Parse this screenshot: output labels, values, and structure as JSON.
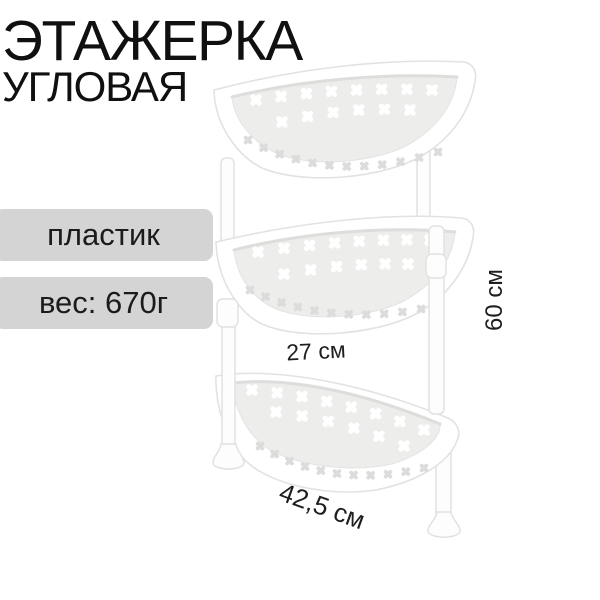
{
  "title": {
    "line1": "ЭТАЖЕРКА",
    "line2": "УГЛОВАЯ"
  },
  "spec_badges": [
    {
      "id": "material",
      "label": "пластик"
    },
    {
      "id": "weight",
      "label": "вес: 670г"
    }
  ],
  "dimension_labels": {
    "height": "60 см",
    "shelf_depth": "27 см",
    "width": "42,5 см"
  },
  "product": {
    "name": "corner-shelf-3-tier",
    "tiers": 3
  },
  "colors": {
    "text": "#101010",
    "badge_bg": "#d4d4d4",
    "badge_text": "#1b1b1b",
    "dim_text": "#1e1e1e",
    "product_white": "#ffffff",
    "product_outline": "#e2e2e2",
    "product_floor": "#ededec",
    "hole_floor": "#ffffff",
    "hole_wall": "#dcdcdc",
    "background": "#ffffff"
  }
}
